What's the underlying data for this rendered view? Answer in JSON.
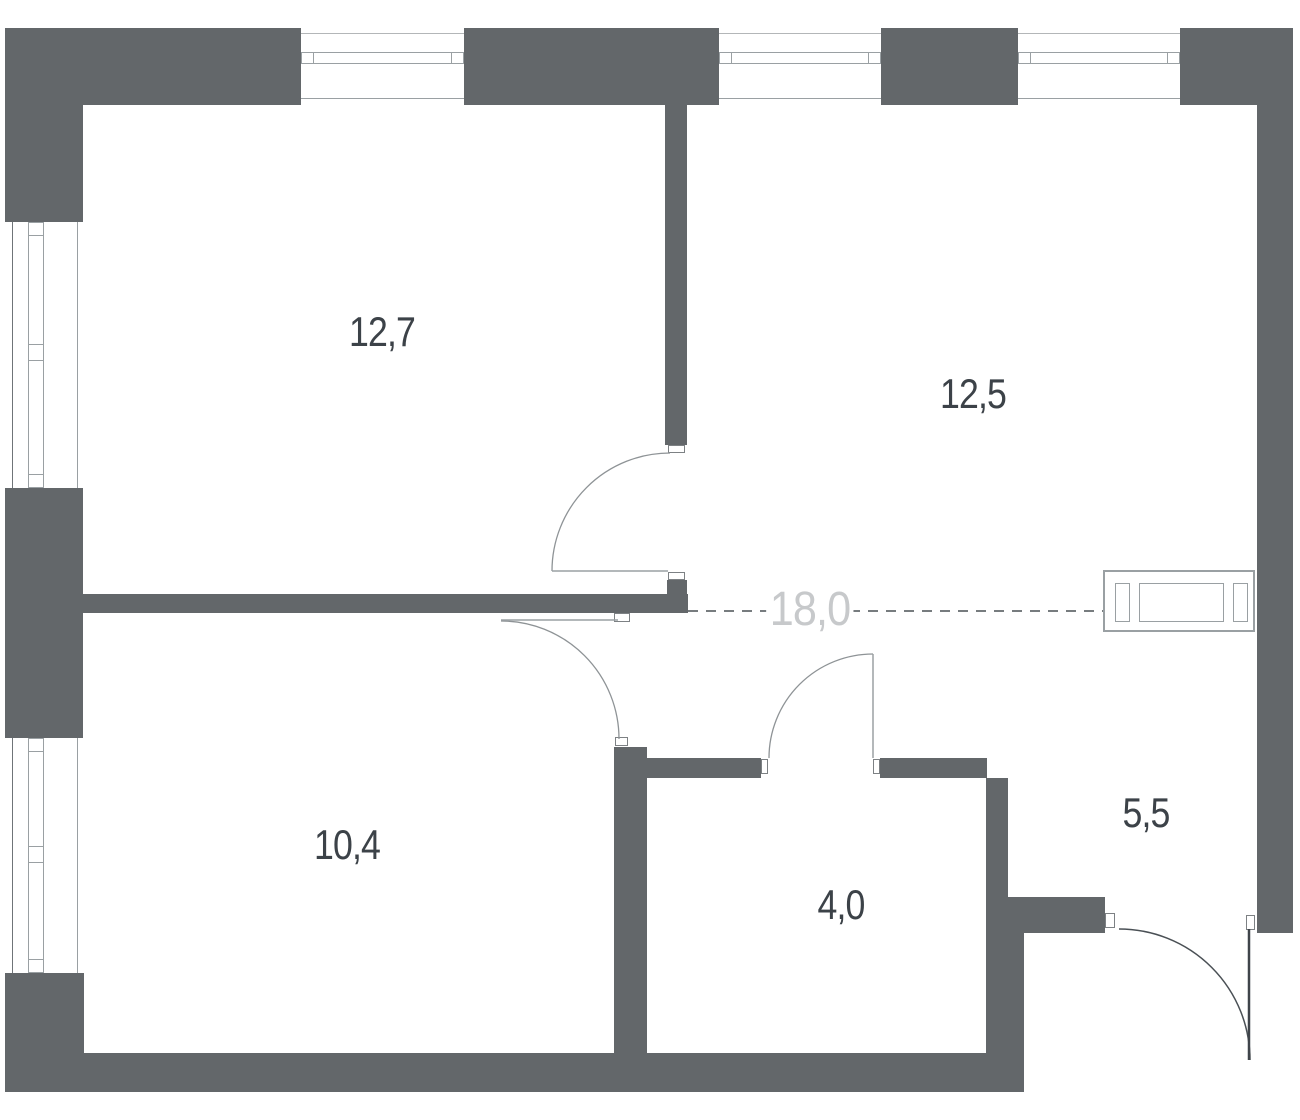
{
  "page": {
    "type": "apartment-floor-plan"
  },
  "labels": {
    "rooms": [
      {
        "id": "room-top-left",
        "area": "12,7"
      },
      {
        "id": "room-top-right",
        "area": "12,5"
      },
      {
        "id": "room-bottom-left",
        "area": "10,4"
      },
      {
        "id": "bathroom",
        "area": "4,0"
      },
      {
        "id": "hallway",
        "area": "5,5"
      }
    ],
    "total_area": "18,0"
  },
  "colors": {
    "wall": "#63676a",
    "room_text": "#3c4248",
    "total_area_text": "#c7c9cb",
    "window_line": "#9aa0a3",
    "dashed_line": "#4a5055"
  }
}
